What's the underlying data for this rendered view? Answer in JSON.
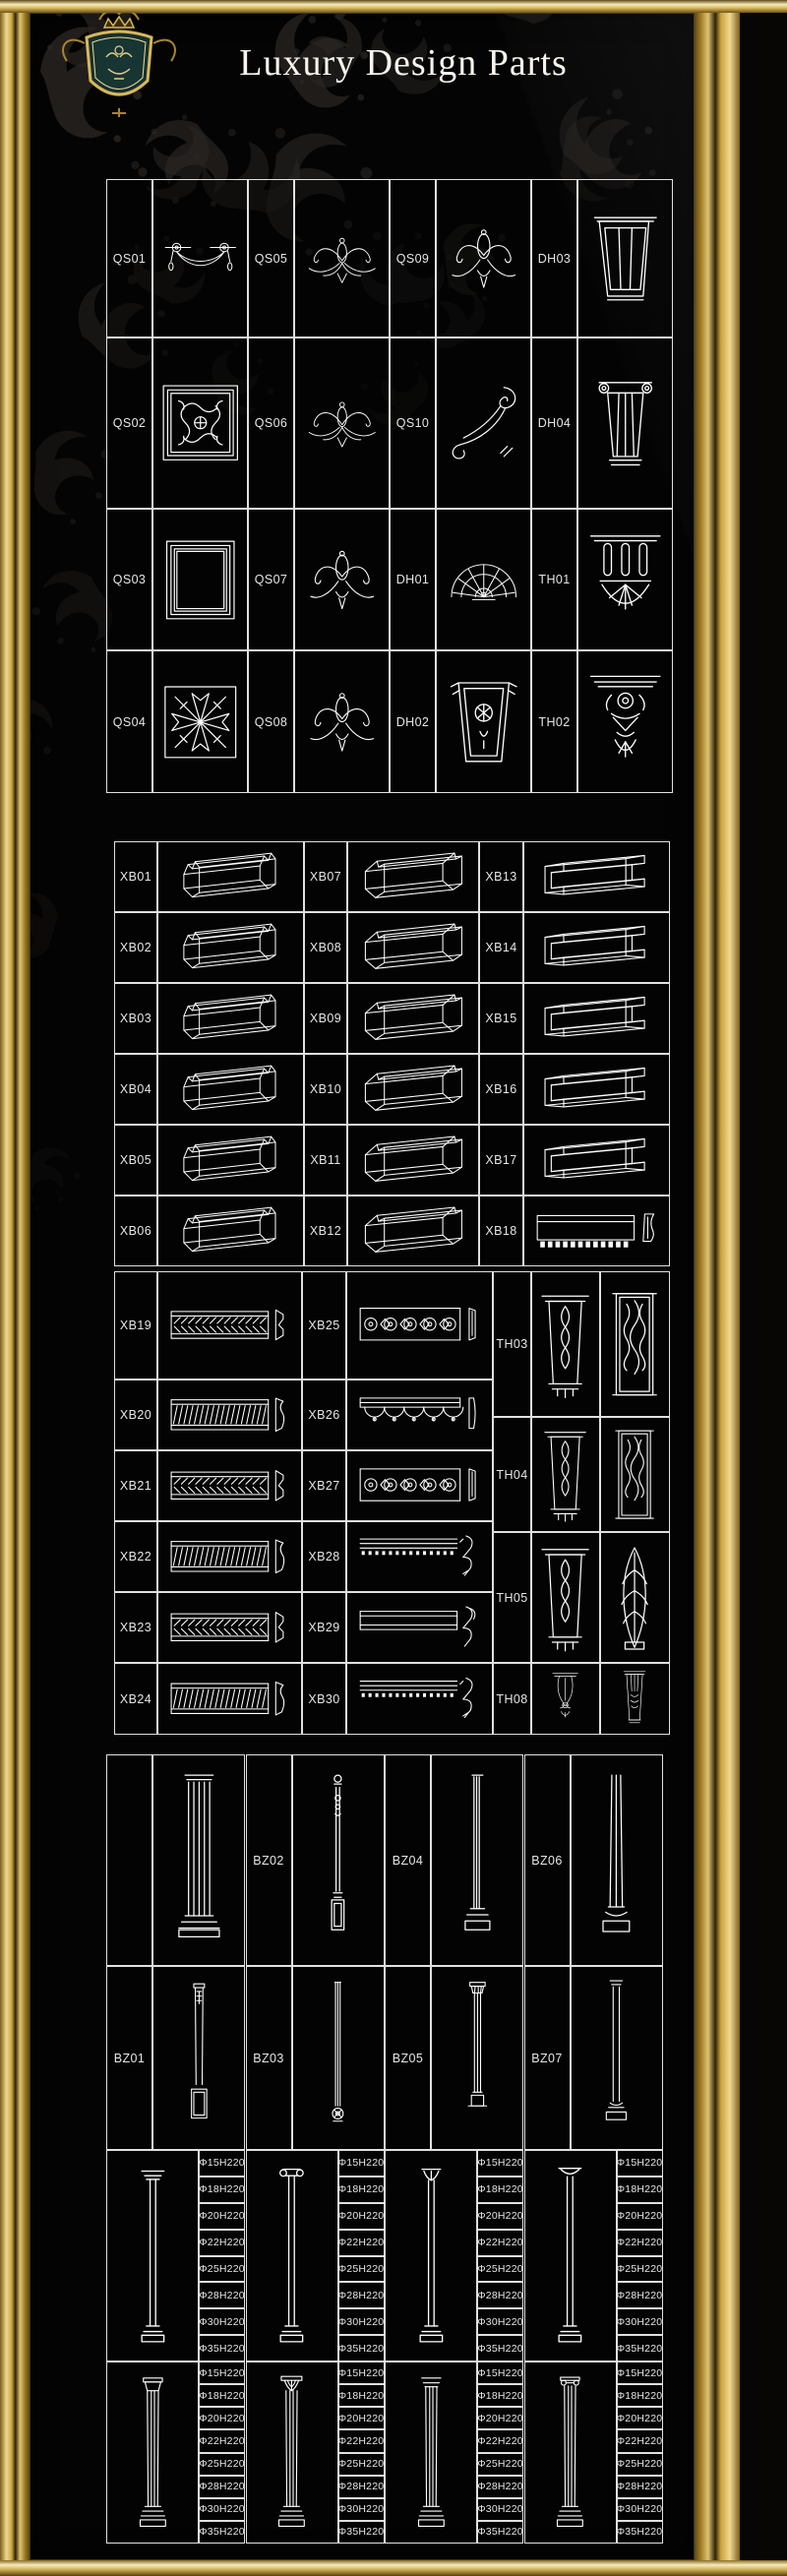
{
  "page": {
    "title": "Luxury Design Parts"
  },
  "brand": {
    "crest_icon": "royal-crest",
    "colors": {
      "gold": "#d4af37",
      "gold_light": "#f3e3a5",
      "gold_dark": "#6e5318",
      "background": "#040404",
      "line": "#ffffff",
      "label_text": "#e6e6e6",
      "damask": "#2b2724",
      "shield": "#16302f"
    }
  },
  "section_ornaments": {
    "rows": [
      [
        {
          "label": "QS01",
          "glyph": "swag"
        },
        {
          "label": "QS05",
          "glyph": "crest-wide"
        },
        {
          "label": "QS09",
          "glyph": "crest-compact"
        },
        {
          "label": "DH03",
          "glyph": "corbel-trapezoid"
        }
      ],
      [
        {
          "label": "QS02",
          "glyph": "panel-ornate"
        },
        {
          "label": "QS06",
          "glyph": "crest-wide"
        },
        {
          "label": "QS10",
          "glyph": "corner-scroll"
        },
        {
          "label": "DH04",
          "glyph": "corbel-fluted"
        }
      ],
      [
        {
          "label": "QS03",
          "glyph": "panel-frame"
        },
        {
          "label": "QS07",
          "glyph": "crest-compact"
        },
        {
          "label": "DH01",
          "glyph": "fan-shell"
        },
        {
          "label": "TH01",
          "glyph": "pendant-bracket"
        }
      ],
      [
        {
          "label": "QS04",
          "glyph": "panel-star"
        },
        {
          "label": "QS08",
          "glyph": "crest-compact"
        },
        {
          "label": "DH02",
          "glyph": "keystone-shell"
        },
        {
          "label": "TH02",
          "glyph": "corbel-ornate"
        }
      ]
    ]
  },
  "section_moldings_3d": {
    "rows": [
      [
        {
          "label": "XB01",
          "glyph": "molding3d-a"
        },
        {
          "label": "XB07",
          "glyph": "molding3d-b"
        },
        {
          "label": "XB13",
          "glyph": "molding3d-c"
        }
      ],
      [
        {
          "label": "XB02",
          "glyph": "molding3d-a"
        },
        {
          "label": "XB08",
          "glyph": "molding3d-b"
        },
        {
          "label": "XB14",
          "glyph": "molding3d-c"
        }
      ],
      [
        {
          "label": "XB03",
          "glyph": "molding3d-a"
        },
        {
          "label": "XB09",
          "glyph": "molding3d-b"
        },
        {
          "label": "XB15",
          "glyph": "molding3d-c"
        }
      ],
      [
        {
          "label": "XB04",
          "glyph": "molding3d-a"
        },
        {
          "label": "XB10",
          "glyph": "molding3d-b"
        },
        {
          "label": "XB16",
          "glyph": "molding3d-c"
        }
      ],
      [
        {
          "label": "XB05",
          "glyph": "molding3d-a"
        },
        {
          "label": "XB11",
          "glyph": "molding3d-b"
        },
        {
          "label": "XB17",
          "glyph": "molding3d-c"
        }
      ],
      [
        {
          "label": "XB06",
          "glyph": "molding3d-a"
        },
        {
          "label": "XB12",
          "glyph": "molding3d-b"
        },
        {
          "label": "XB18",
          "glyph": "flat-dentil"
        }
      ]
    ]
  },
  "section_moldings_flat": {
    "left_rows": [
      [
        {
          "label": "XB19",
          "glyph": "flat-hatch-a"
        },
        {
          "label": "XB25",
          "glyph": "ornate-rosette"
        }
      ],
      [
        {
          "label": "XB20",
          "glyph": "flat-hatch-b"
        },
        {
          "label": "XB26",
          "glyph": "ornate-swag"
        }
      ],
      [
        {
          "label": "XB21",
          "glyph": "flat-hatch-a"
        },
        {
          "label": "XB27",
          "glyph": "ornate-rosette"
        }
      ],
      [
        {
          "label": "XB22",
          "glyph": "flat-hatch-b"
        },
        {
          "label": "XB28",
          "glyph": "crown-profile-a"
        }
      ],
      [
        {
          "label": "XB23",
          "glyph": "flat-hatch-a"
        },
        {
          "label": "XB29",
          "glyph": "crown-profile-b"
        }
      ],
      [
        {
          "label": "XB24",
          "glyph": "flat-hatch-b"
        },
        {
          "label": "XB30",
          "glyph": "crown-profile-a"
        }
      ]
    ],
    "right_rows": [
      {
        "label": "TH03",
        "glyphs": [
          "pilaster-bracket",
          "pilaster-panel"
        ]
      },
      {
        "label": "TH04",
        "glyphs": [
          "pilaster-bracket",
          "pilaster-panel"
        ]
      },
      {
        "label": "TH05",
        "glyphs": [
          "pilaster-bracket",
          "pilaster-leaf"
        ]
      },
      {
        "label": "TH08",
        "glyphs": [
          "corbel-scroll",
          "corbel-vase"
        ]
      }
    ]
  },
  "section_columns": {
    "rows": [
      [
        {
          "label": "",
          "glyph": "pilaster-fluted-tall"
        },
        {
          "label": "BZ02",
          "glyph": "baluster-slim"
        },
        {
          "label": "BZ04",
          "glyph": "column-slim-fluted"
        },
        {
          "label": "BZ06",
          "glyph": "column-taper"
        }
      ],
      [
        {
          "label": "BZ01",
          "glyph": "pilaster-small"
        },
        {
          "label": "BZ03",
          "glyph": "column-slim-long"
        },
        {
          "label": "BZ05",
          "glyph": "column-capital-small"
        },
        {
          "label": "BZ07",
          "glyph": "column-tuscan"
        }
      ]
    ]
  },
  "section_column_sizes": {
    "blocks": [
      {
        "units": [
          {
            "glyph": "colsm-doric",
            "sizes": [
              "Φ15H220",
              "Φ18H220",
              "Φ20H220",
              "Φ22H220",
              "Φ25H220",
              "Φ28H220",
              "Φ30H220",
              "Φ35H220"
            ]
          },
          {
            "glyph": "colsm-scroll",
            "sizes": [
              "Φ15H220",
              "Φ18H220",
              "Φ20H220",
              "Φ22H220",
              "Φ25H220",
              "Φ28H220",
              "Φ30H220",
              "Φ35H220"
            ]
          },
          {
            "glyph": "colsm-leaf",
            "sizes": [
              "Φ15H220",
              "Φ18H220",
              "Φ20H220",
              "Φ22H220",
              "Φ25H220",
              "Φ28H220",
              "Φ30H220",
              "Φ35H220"
            ]
          },
          {
            "glyph": "colsm-flare",
            "sizes": [
              "Φ15H220",
              "Φ18H220",
              "Φ20H220",
              "Φ22H220",
              "Φ25H220",
              "Φ28H220",
              "Φ30H220",
              "Φ35H220"
            ]
          }
        ]
      },
      {
        "units": [
          {
            "glyph": "colfull-doric",
            "sizes": [
              "Φ15H220",
              "Φ18H220",
              "Φ20H220",
              "Φ22H220",
              "Φ25H220",
              "Φ28H220",
              "Φ30H220",
              "Φ35H220"
            ]
          },
          {
            "glyph": "colfull-corinthian",
            "sizes": [
              "Φ15H220",
              "Φ18H220",
              "Φ20H220",
              "Φ22H220",
              "Φ25H220",
              "Φ28H220",
              "Φ30H220",
              "Φ35H220"
            ]
          },
          {
            "glyph": "colfull-tuscan",
            "sizes": [
              "Φ15H220",
              "Φ18H220",
              "Φ20H220",
              "Φ22H220",
              "Φ25H220",
              "Φ28H220",
              "Φ30H220",
              "Φ35H220"
            ]
          },
          {
            "glyph": "colfull-fluted",
            "sizes": [
              "Φ15H220",
              "Φ18H220",
              "Φ20H220",
              "Φ22H220",
              "Φ25H220",
              "Φ28H220",
              "Φ30H220",
              "Φ35H220"
            ]
          }
        ]
      }
    ]
  }
}
